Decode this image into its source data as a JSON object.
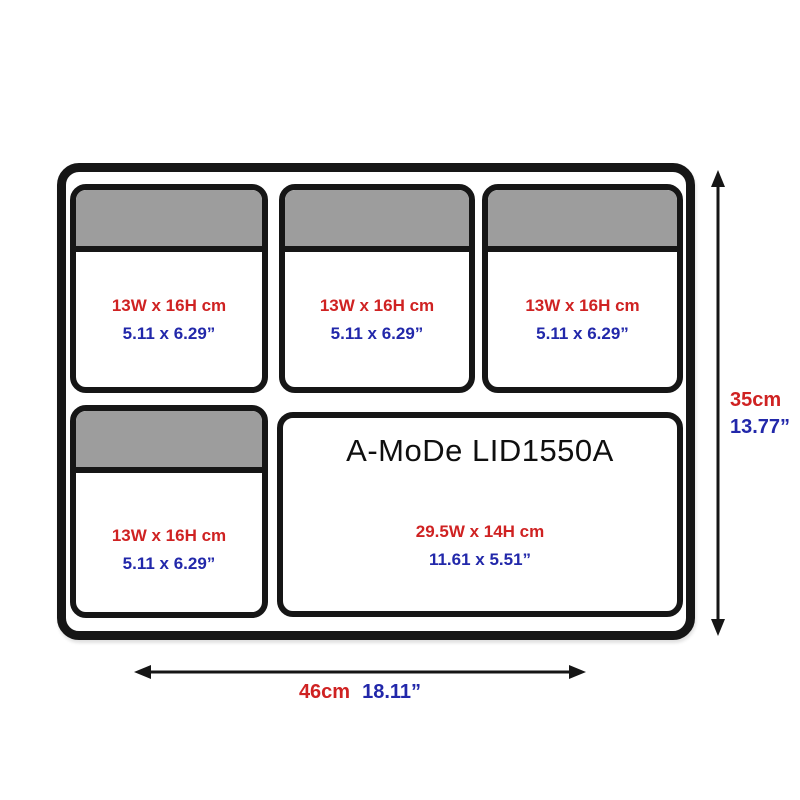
{
  "compartments": [
    {
      "name": "top-left-pocket",
      "metric": "13W x 16H cm",
      "imperial": "5.11 x 6.29”"
    },
    {
      "name": "top-middle-pocket",
      "metric": "13W x 16H cm",
      "imperial": "5.11 x 6.29”"
    },
    {
      "name": "top-right-pocket",
      "metric": "13W x 16H cm",
      "imperial": "5.11 x 6.29”"
    },
    {
      "name": "bottom-left-pocket",
      "metric": "13W x 16H cm",
      "imperial": "5.11 x 6.29”"
    },
    {
      "name": "main-pocket",
      "title": "A-MoDe LID1550A",
      "metric": "29.5W x 14H cm",
      "imperial": "11.61 x 5.51”"
    }
  ],
  "overall_dimensions": {
    "height_metric": "35cm",
    "height_imperial": "13.77”",
    "width_metric": "46cm",
    "width_imperial": "18.11”"
  },
  "colors": {
    "metric_red": "#cf2222",
    "imperial_blue": "#2228aa",
    "flap_gray": "#9d9d9d",
    "outline_black": "#161616"
  }
}
